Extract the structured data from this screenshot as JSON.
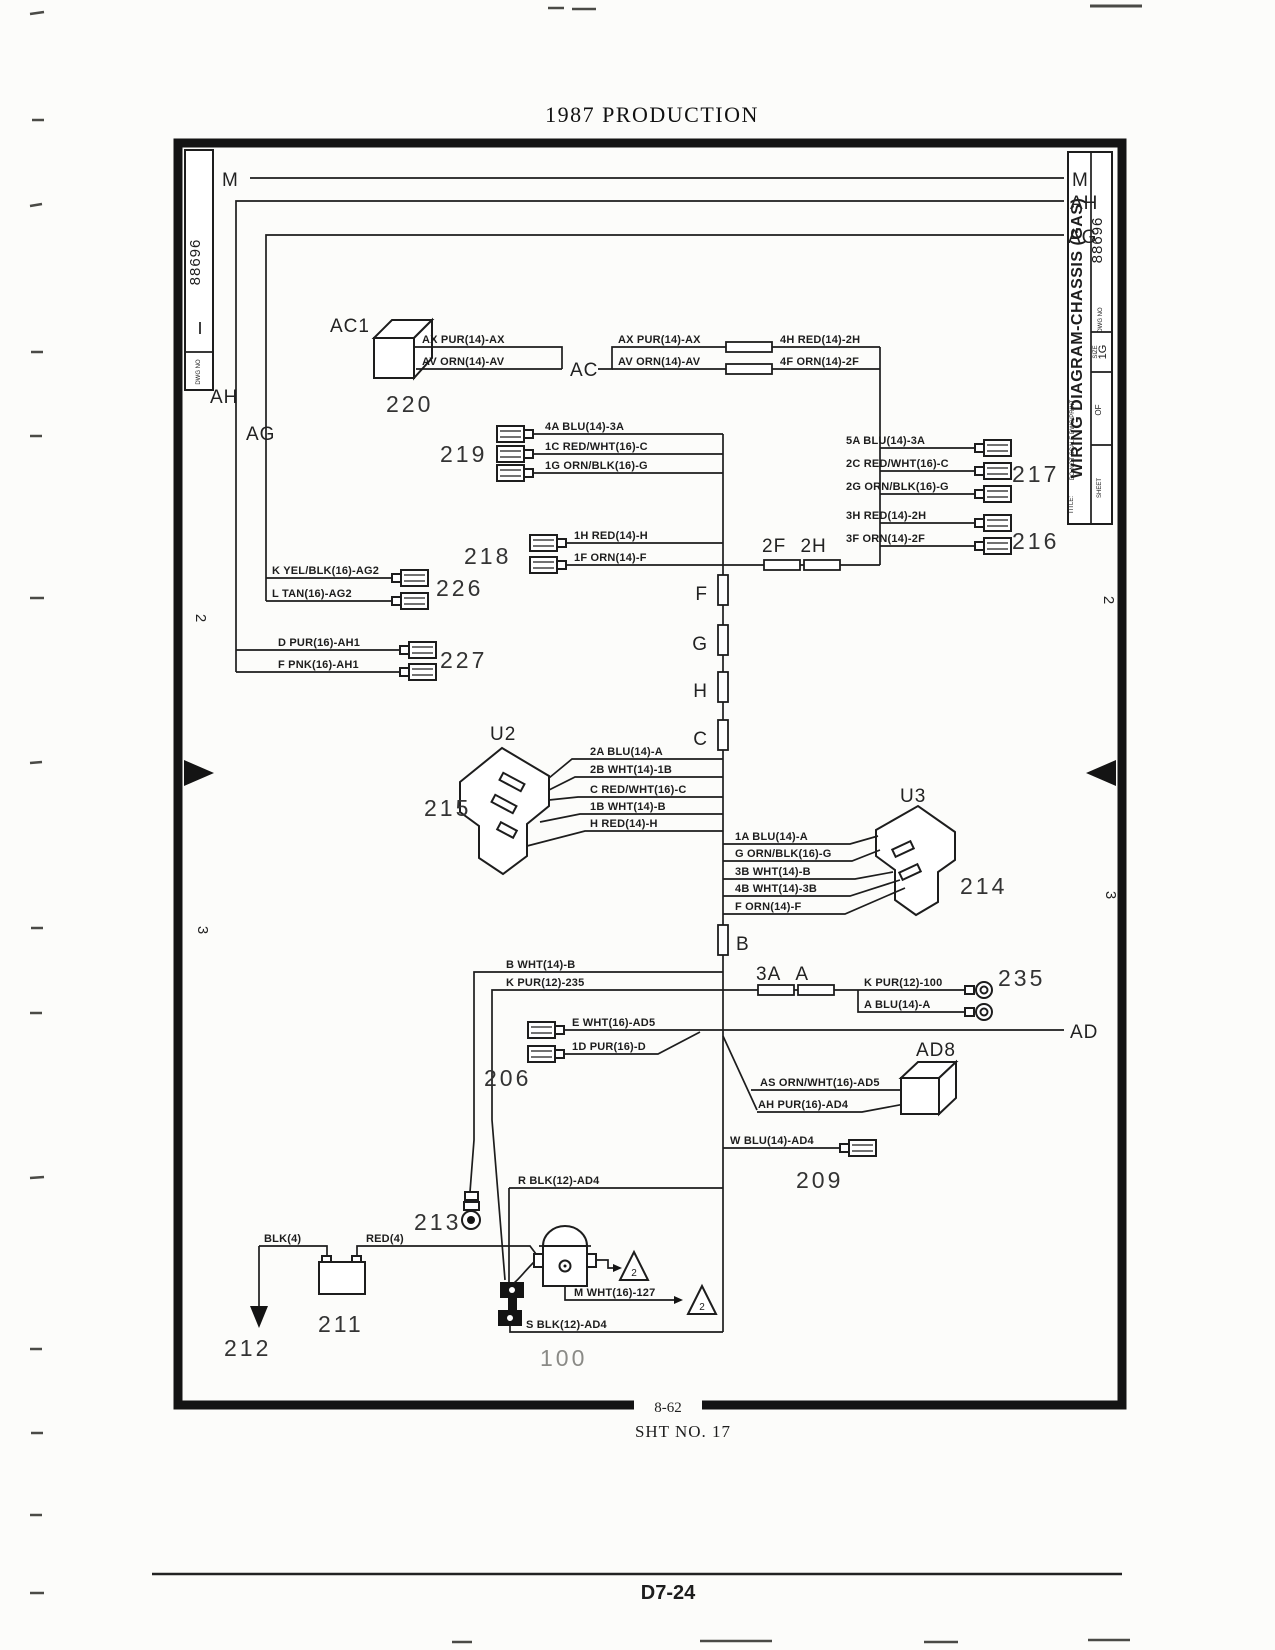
{
  "colors": {
    "ink": "#1d1d1d",
    "paper": "#fcfcfa"
  },
  "page": {
    "header": "1987 PRODUCTION",
    "page_number": "D7-24"
  },
  "frame": {
    "page_ref": "8-62",
    "sheet_no": "SHT NO. 17"
  },
  "left_strip": {
    "dwg_value": "88696",
    "dwg_label": "DWG NO"
  },
  "title_block": {
    "title_label": "TITLE:",
    "title": "WIRING DIAGRAM-CHASSIS (GAS)",
    "dwg_value": "88696",
    "dwg_label": "DWG NO",
    "size_label": "SIZE",
    "size_value": "1G",
    "scale_note": "DO NOT SCALE DWG/PRINT",
    "sheet_label": "SHEET",
    "of_label": "OF"
  },
  "zones": {
    "z2": "2",
    "z3": "3"
  },
  "bus_labels": {
    "m": "M",
    "ah": "AH",
    "ag": "AG",
    "ac": "AC",
    "ad": "AD"
  },
  "fuse_labels": {
    "f": "F",
    "g": "G",
    "h": "H",
    "c": "C",
    "b": "B"
  },
  "splice_labels": {
    "fh": "2F 2H",
    "aa": "3A A"
  },
  "components": {
    "ac1": "AC1",
    "n220": "220",
    "n219": "219",
    "n218": "218",
    "n217": "217",
    "n216": "216",
    "n226": "226",
    "n227": "227",
    "u2": "U2",
    "n215": "215",
    "u3": "U3",
    "n214": "214",
    "n235": "235",
    "n206": "206",
    "ad8": "AD8",
    "n209": "209",
    "n213": "213",
    "n211": "211",
    "n212": "212",
    "n100": "100",
    "tri1": "2",
    "tri2": "2"
  },
  "wires": {
    "ax1": "AX PUR(14)-AX",
    "av1": "AV ORN(14)-AV",
    "ax2": "AX PUR(14)-AX",
    "av2": "AV ORN(14)-AV",
    "h4": "4H RED(14)-2H",
    "f4": "4F ORN(14)-2F",
    "a5": "5A BLU(14)-3A",
    "c2": "2C RED/WHT(16)-C",
    "g2": "2G ORN/BLK(16)-G",
    "h3": "3H RED(14)-2H",
    "f3": "3F ORN(14)-2F",
    "a4": "4A BLU(14)-3A",
    "c1": "1C RED/WHT(16)-C",
    "g1": "1G ORN/BLK(16)-G",
    "h1": "1H RED(14)-H",
    "f1": "1F ORN(14)-F",
    "kyel": "K YEL/BLK(16)-AG2",
    "ltan": "L TAN(16)-AG2",
    "dpur": "D PUR(16)-AH1",
    "fpnk": "F PNK(16)-AH1",
    "a2": "2A BLU(14)-A",
    "b2": "2B WHT(14)-1B",
    "crw": "C RED/WHT(16)-C",
    "b1": "1B WHT(14)-B",
    "hred": "H RED(14)-H",
    "a1": "1A BLU(14)-A",
    "gob": "G ORN/BLK(16)-G",
    "b3": "3B WHT(14)-B",
    "b4": "4B WHT(14)-3B",
    "forn": "F ORN(14)-F",
    "bwht": "B WHT(14)-B",
    "kpur235": "K PUR(12)-235",
    "kpur100": "K PUR(12)-100",
    "ablu": "A BLU(14)-A",
    "ewht": "E WHT(16)-AD5",
    "dpur1": "1D PUR(16)-D",
    "asorn": "AS ORN/WHT(16)-AD5",
    "ahpur": "AH PUR(16)-AD4",
    "wblu": "W BLU(14)-AD4",
    "rblk": "R BLK(12)-AD4",
    "blk4": "BLK(4)",
    "red4": "RED(4)",
    "mwht": "M WHT(16)-127",
    "sblk": "S BLK(12)-AD4"
  }
}
